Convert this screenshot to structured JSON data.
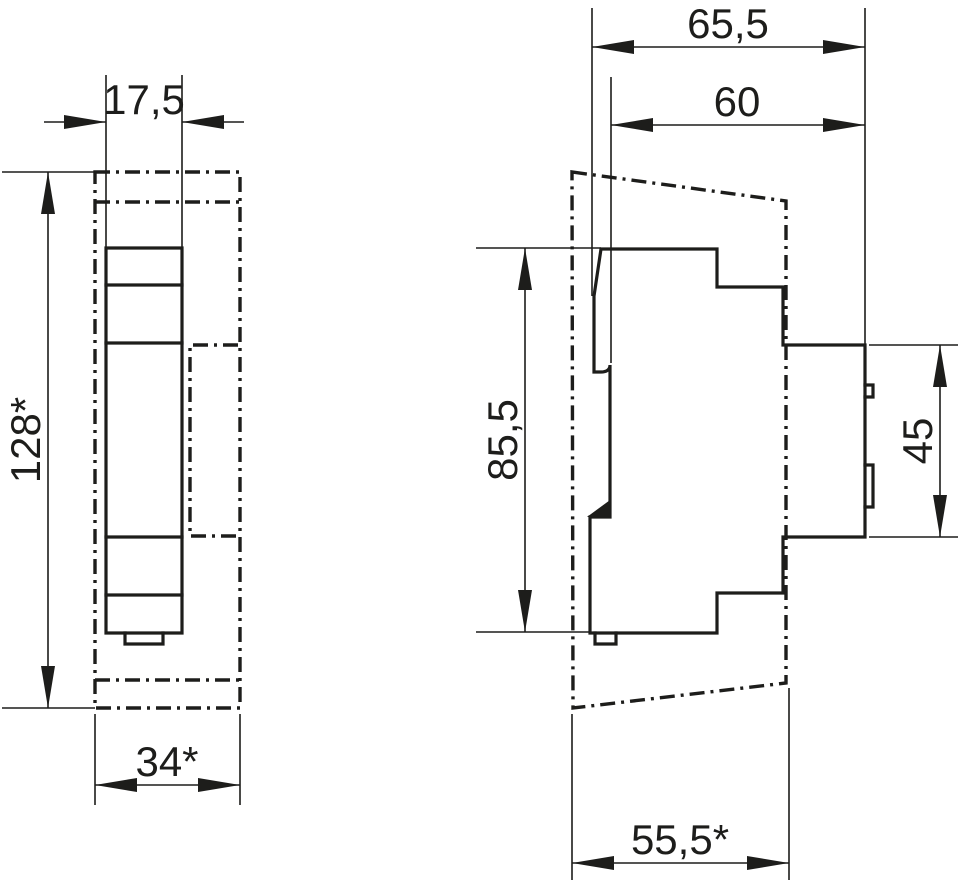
{
  "drawing": {
    "type": "technical-dimension-drawing",
    "background_color": "#ffffff",
    "line_color": "#1d1d1b",
    "views": {
      "front": {
        "name": "front-view",
        "label_device_width": "17,5",
        "label_overall_height": "128*",
        "label_overall_width_with_accessory": "34*"
      },
      "side": {
        "name": "side-view",
        "label_overall_depth": "65,5",
        "label_body_depth": "60",
        "label_body_height": "85,5",
        "label_terminal_zone_height": "45",
        "label_lower_depth": "55,5*"
      }
    }
  }
}
